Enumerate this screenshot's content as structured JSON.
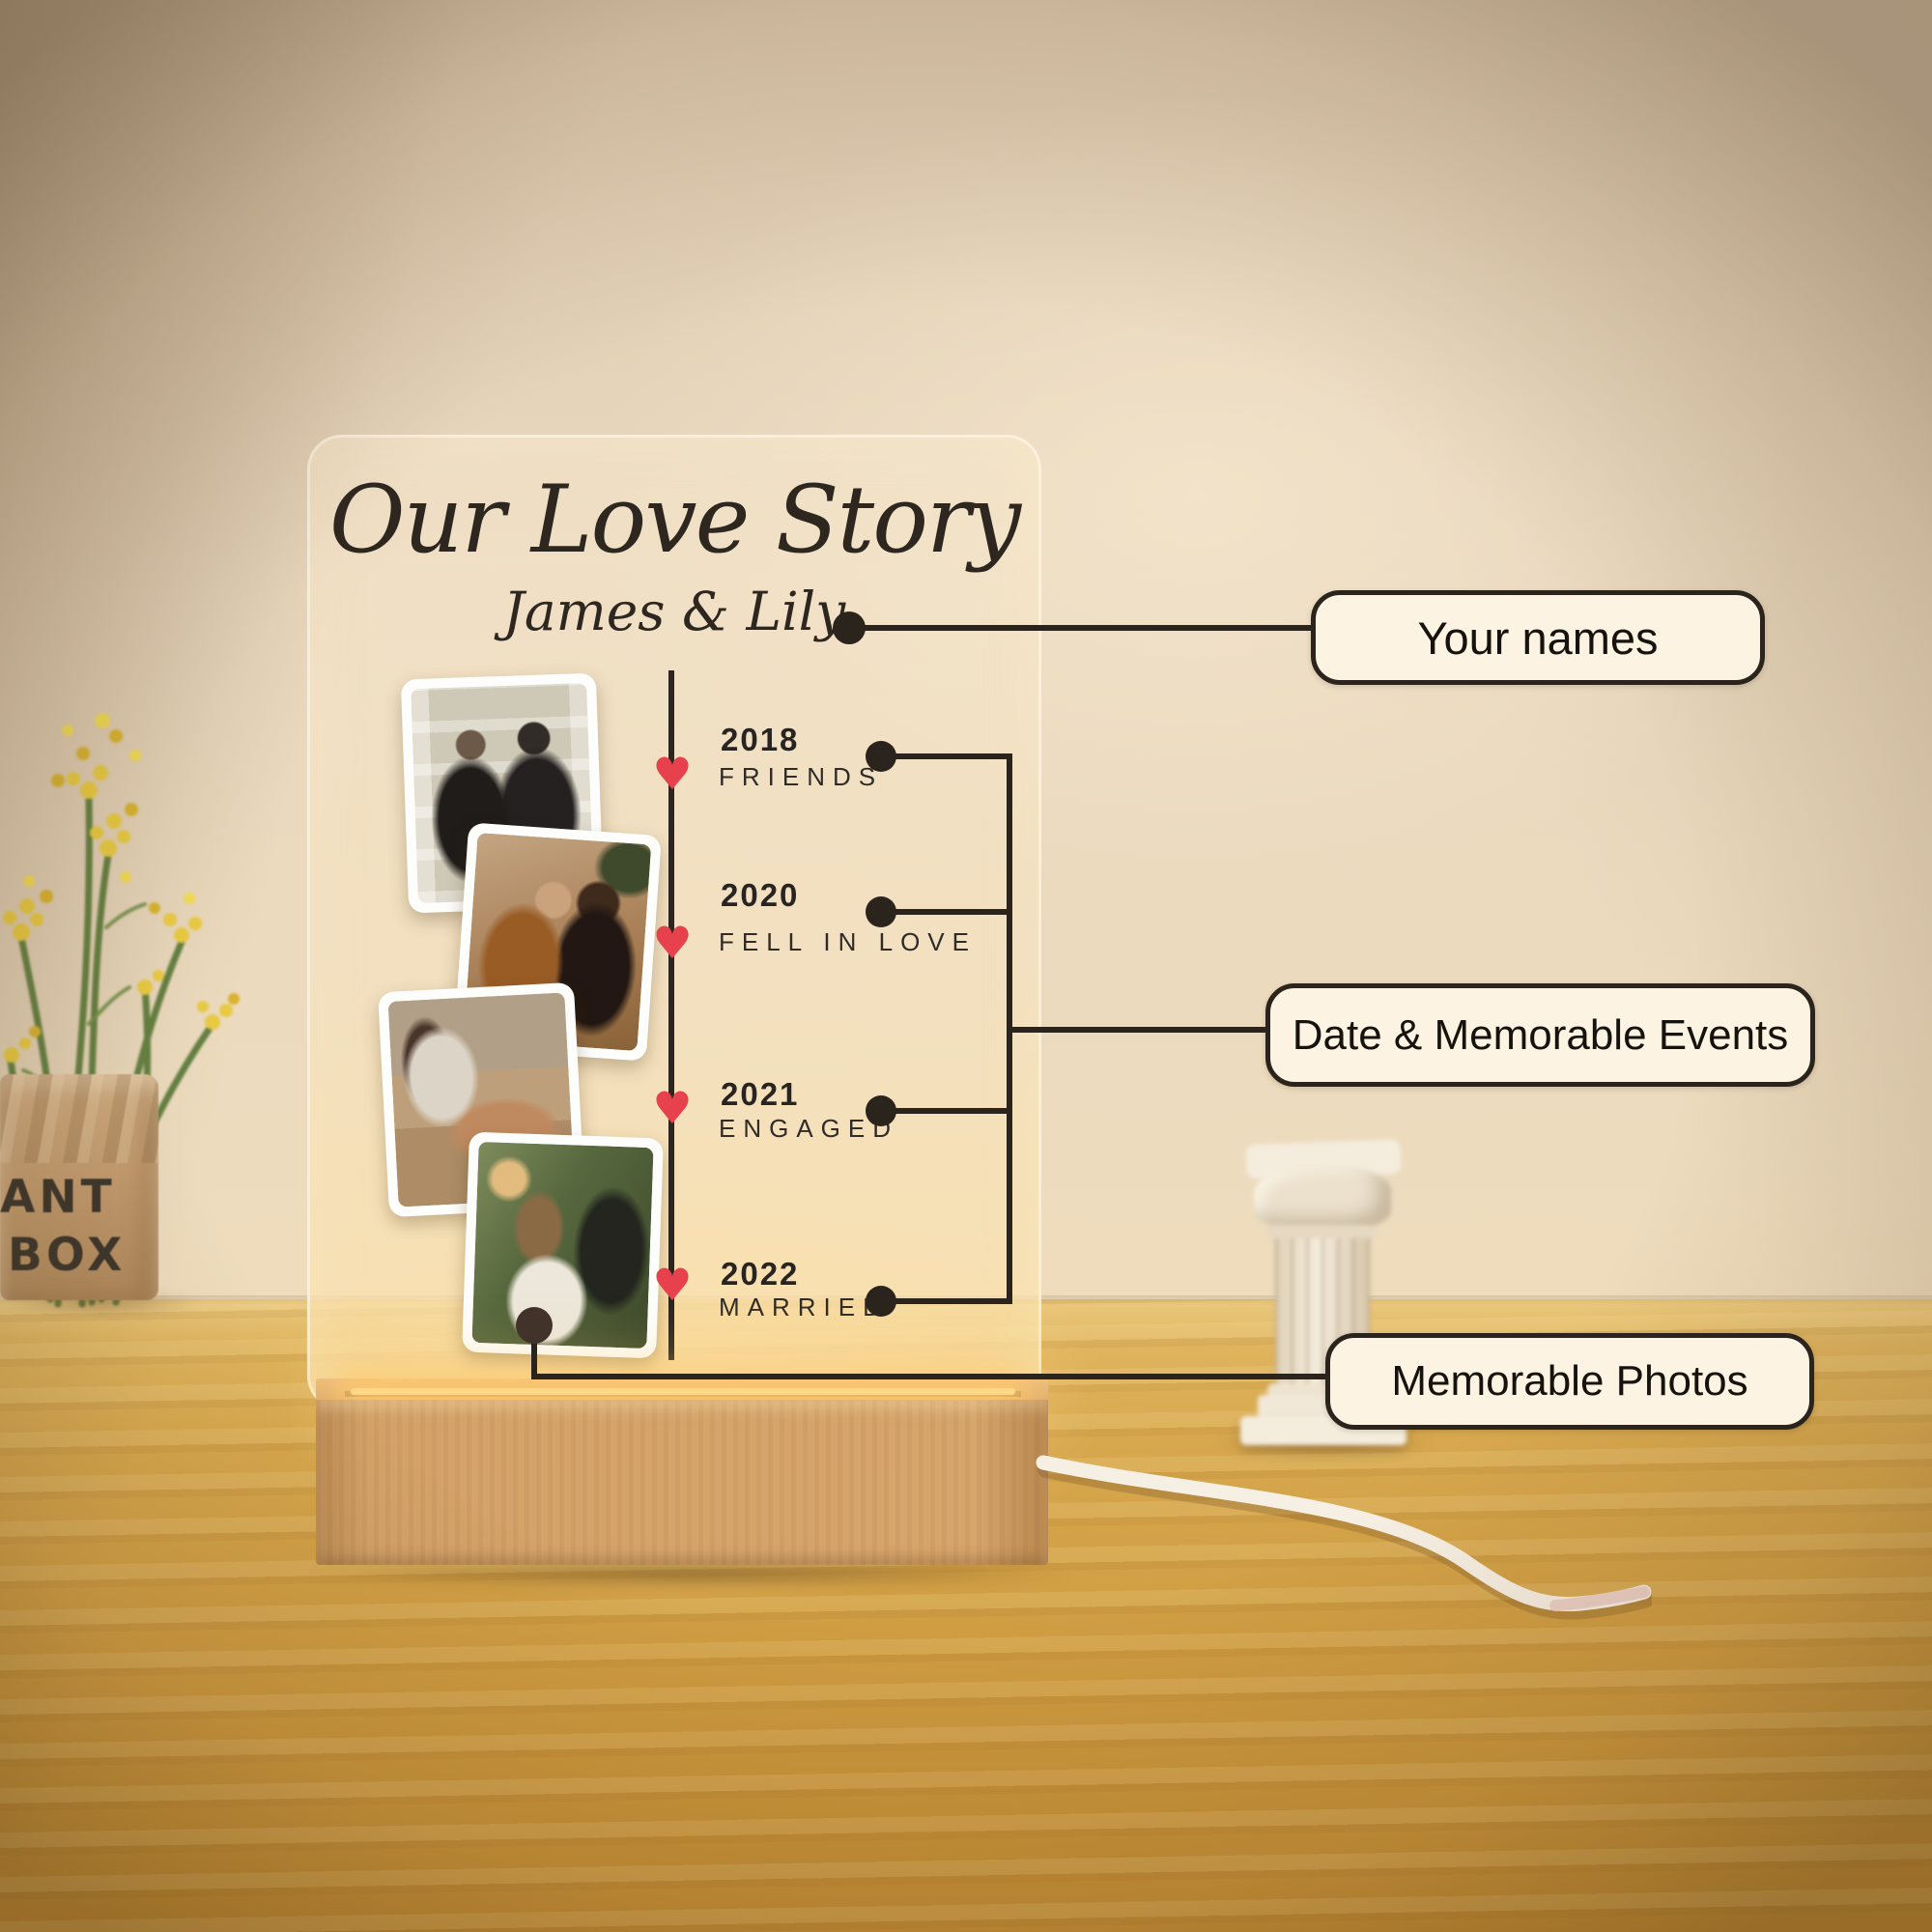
{
  "plaque": {
    "title": "Our Love Story",
    "subtitle": "James & Lily",
    "timeline": [
      {
        "year": "2018",
        "event": "FRIENDS"
      },
      {
        "year": "2020",
        "event": "FELL IN LOVE"
      },
      {
        "year": "2021",
        "event": "ENGAGED"
      },
      {
        "year": "2022",
        "event": "MARRIED"
      }
    ]
  },
  "callouts": [
    {
      "label": "Your names"
    },
    {
      "label": "Date & Memorable Events"
    },
    {
      "label": "Memorable Photos"
    }
  ],
  "scene": {
    "plant_pot_lines": [
      "LANT",
      "BOX"
    ]
  },
  "icons": {
    "heart": "♥"
  },
  "colors": {
    "heart": "#e8414e",
    "annotation_line": "#2b241d",
    "callout_bg": "#fdf3e2",
    "callout_border": "#2b241d",
    "engraving_text": "#2c2620",
    "wall": "#e7d6bd",
    "table_wood": "#d2a048",
    "base_wood": "#d2a167",
    "led_glow": "#ffd887"
  }
}
